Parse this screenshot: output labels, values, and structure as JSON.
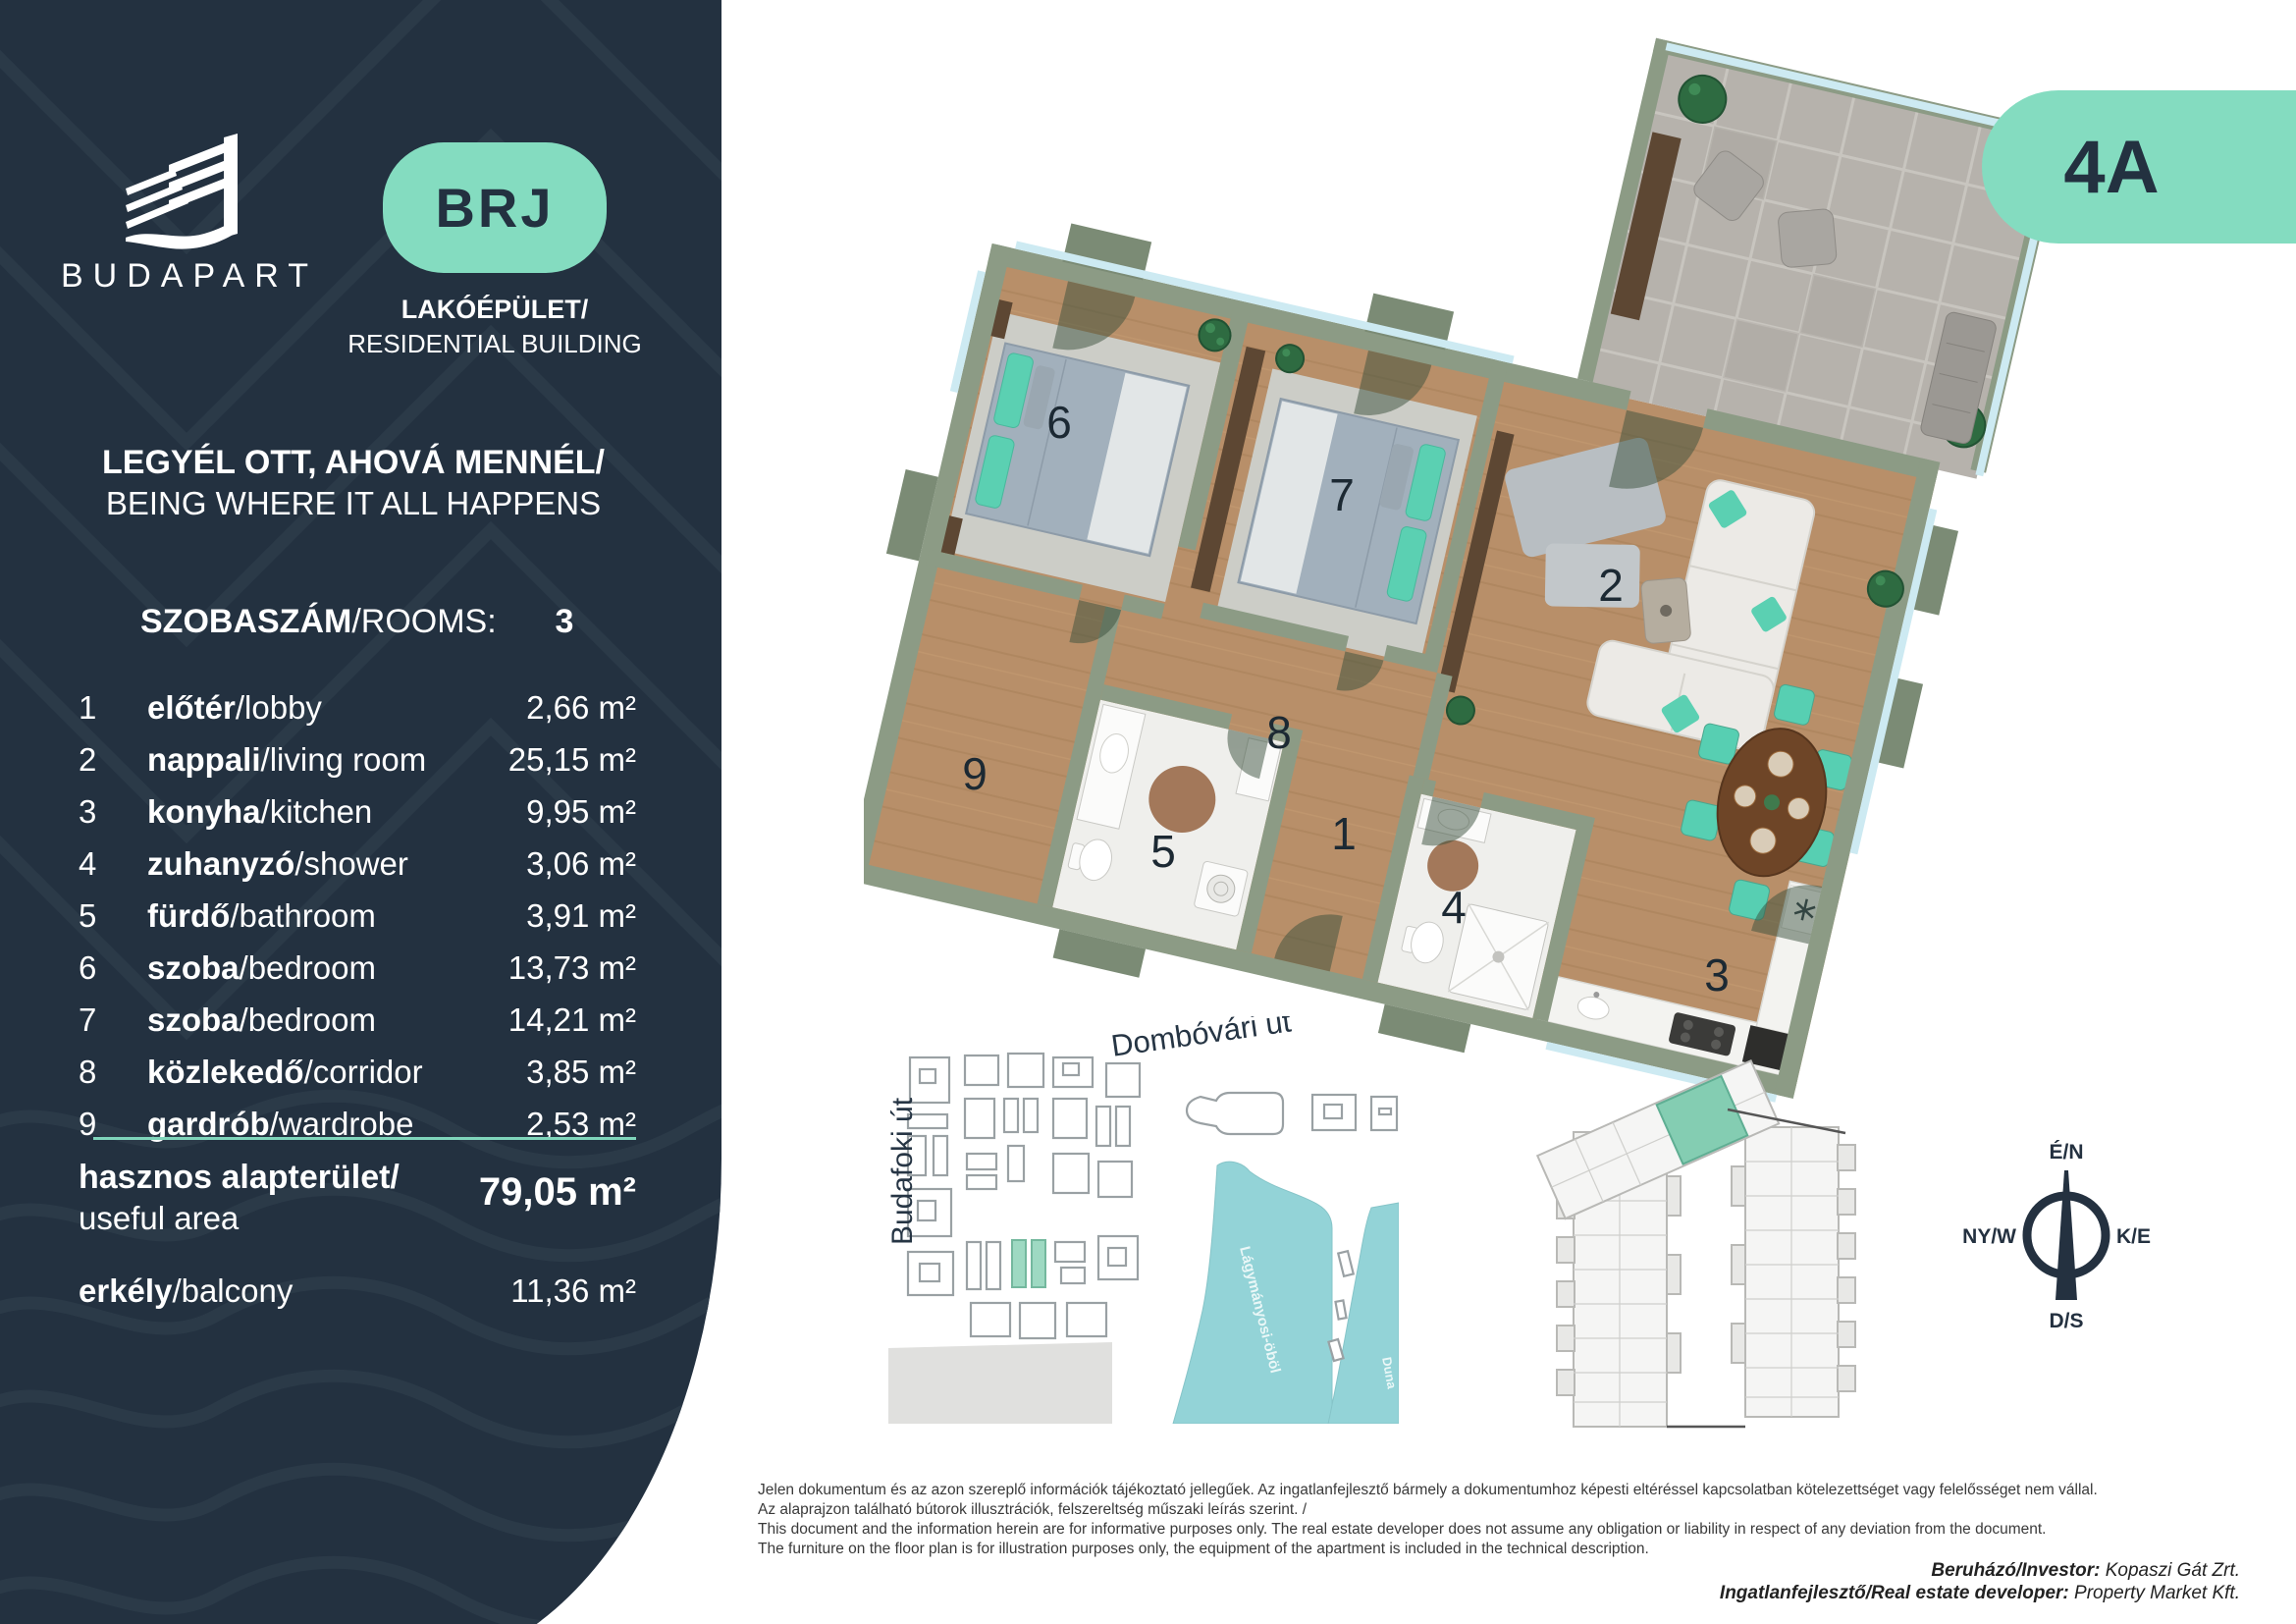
{
  "brand": {
    "name": "BUDAPART"
  },
  "unit_badge": "BRJ",
  "apartment_code": "4A",
  "building_type": {
    "hu": "LAKÓÉPÜLET/",
    "en": "RESIDENTIAL BUILDING"
  },
  "tagline": {
    "hu": "LEGYÉL OTT, AHOVÁ MENNÉL/",
    "en": "BEING WHERE IT ALL HAPPENS"
  },
  "rooms_header": {
    "hu": "SZOBASZÁM",
    "en": "/ROOMS:",
    "value": "3"
  },
  "rooms": [
    {
      "num": "1",
      "hu": "előtér",
      "en": "/lobby",
      "area": "2,66 m²"
    },
    {
      "num": "2",
      "hu": "nappali",
      "en": "/living room",
      "area": "25,15 m²"
    },
    {
      "num": "3",
      "hu": "konyha",
      "en": "/kitchen",
      "area": "9,95 m²"
    },
    {
      "num": "4",
      "hu": "zuhanyzó",
      "en": "/shower",
      "area": "3,06 m²"
    },
    {
      "num": "5",
      "hu": "fürdő",
      "en": "/bathroom",
      "area": "3,91 m²"
    },
    {
      "num": "6",
      "hu": "szoba",
      "en": "/bedroom",
      "area": "13,73 m²"
    },
    {
      "num": "7",
      "hu": "szoba",
      "en": "/bedroom",
      "area": "14,21 m²"
    },
    {
      "num": "8",
      "hu": "közlekedő",
      "en": "/corridor",
      "area": "3,85 m²"
    },
    {
      "num": "9",
      "hu": "gardrób",
      "en": "/wardrobe",
      "area": "2,53 m²"
    }
  ],
  "totals": {
    "useful_hu": "hasznos alapterület/",
    "useful_en": "useful area",
    "useful_area": "79,05 m²",
    "balcony_hu": "erkély",
    "balcony_en": "/balcony",
    "balcony_area": "11,36 m²"
  },
  "floorplan": {
    "numbers": [
      "1",
      "2",
      "3",
      "4",
      "5",
      "6",
      "7",
      "8",
      "9"
    ]
  },
  "map": {
    "street_top": "Dombóvári út",
    "street_left": "Budafoki út",
    "bay": "Lágymányosi-öböl",
    "river": "Duna"
  },
  "compass": {
    "n": "É/N",
    "w": "NY/W",
    "e": "K/E",
    "s": "D/S"
  },
  "disclaimer": [
    "Jelen dokumentum és az azon szereplő információk tájékoztató jellegűek. Az ingatlanfejlesztő bármely a dokumentumhoz képesti eltéréssel kapcsolatban kötelezettséget vagy felelősséget nem vállal.",
    "Az alaprajzon található bútorok illusztrációk, felszereltség műszaki leírás szerint. /",
    "This document and the information herein are for informative purposes only. The real estate developer does not assume any obligation or liability in respect of any deviation from the document.",
    "The furniture on the floor plan is for illustration purposes only, the equipment of the apartment is included in the technical description."
  ],
  "credits": {
    "investor_label": "Beruházó/Investor:",
    "investor": " Kopaszi Gát Zrt.",
    "developer_label": "Ingatlanfejlesztő/Real estate developer:",
    "developer": " Property Market Kft."
  },
  "colors": {
    "navy": "#233140",
    "mint": "#84dcc0",
    "sage": "#8c9b85",
    "wood": "#b88f69",
    "water": "#93d3d7"
  }
}
